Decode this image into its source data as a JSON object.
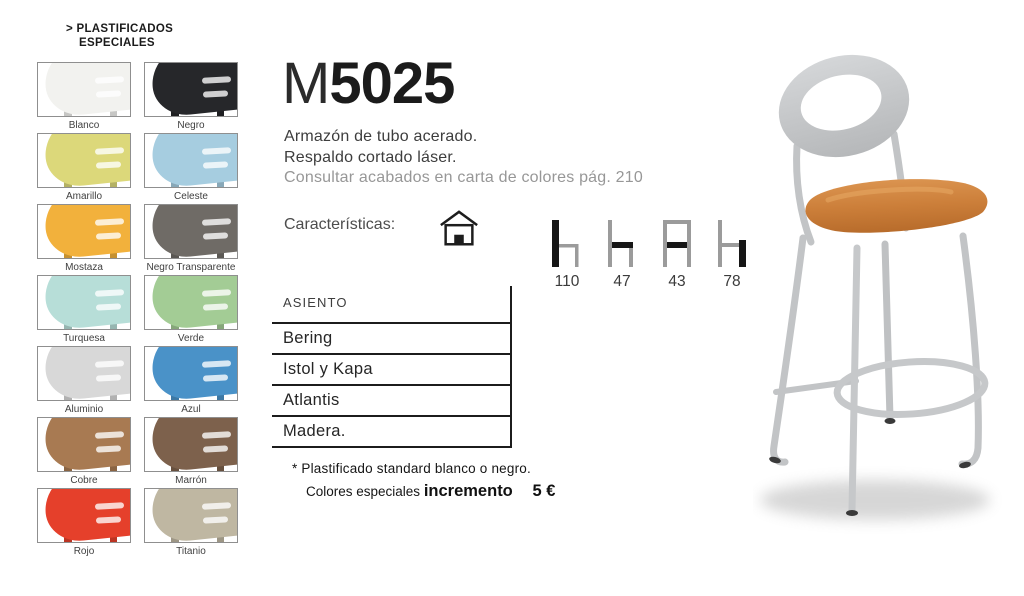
{
  "section_header": {
    "line1": "> PLASTIFICADOS",
    "line2": "ESPECIALES"
  },
  "swatches": {
    "items": [
      {
        "label": "Blanco",
        "color": "#f2f2ef"
      },
      {
        "label": "Negro",
        "color": "#26272a"
      },
      {
        "label": "Amarillo",
        "color": "#dcd87a"
      },
      {
        "label": "Celeste",
        "color": "#a6cde0"
      },
      {
        "label": "Mostaza",
        "color": "#f2b13c"
      },
      {
        "label": "Negro Transparente",
        "color": "#6f6b66"
      },
      {
        "label": "Turquesa",
        "color": "#b7ded8"
      },
      {
        "label": "Verde",
        "color": "#a3cc95"
      },
      {
        "label": "Aluminio",
        "color": "#d8d8d8"
      },
      {
        "label": "Azul",
        "color": "#4a92c8"
      },
      {
        "label": "Cobre",
        "color": "#a87a52"
      },
      {
        "label": "Marrón",
        "color": "#7d614c"
      },
      {
        "label": "Rojo",
        "color": "#e5402b"
      },
      {
        "label": "Titanio",
        "color": "#bfb7a2"
      }
    ]
  },
  "product": {
    "model_prefix": "M",
    "model_number": "5025",
    "description": [
      "Armazón de tubo acerado.",
      "Respaldo cortado láser.",
      "Consultar acabados en carta de colores pág. 210"
    ],
    "features_label": "Características:",
    "features_icon": "house-icon",
    "dimensions": [
      {
        "icon": "chair-total-height-icon",
        "value": "110"
      },
      {
        "icon": "chair-seat-depth-icon",
        "value": "47"
      },
      {
        "icon": "chair-width-icon",
        "value": "43"
      },
      {
        "icon": "chair-seat-height-icon",
        "value": "78"
      }
    ],
    "photo_colors": {
      "frame": "#c2c4c6",
      "seat": "#c9803f",
      "backrest": "#c9cbcd"
    }
  },
  "seat_table": {
    "header": "ASIENTO",
    "rows": [
      "Bering",
      "Istol y Kapa",
      "Atlantis",
      "Madera."
    ]
  },
  "footnote": {
    "line1": "* Plastificado standard blanco o negro.",
    "line2_text": "Colores especiales",
    "line2_bold": "incremento",
    "line2_price": "5 €"
  }
}
